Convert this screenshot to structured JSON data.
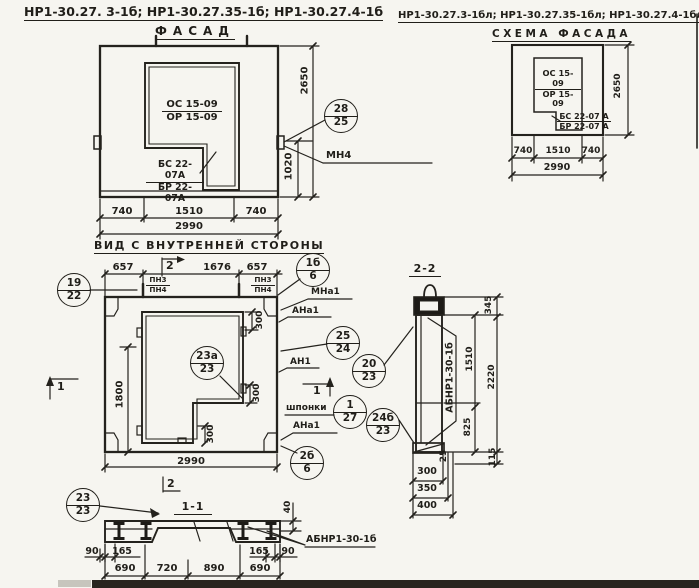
{
  "titles": {
    "left": "НР1-30.27. 3-1б;  НР1-30.27.35-1б;  НР1-30.27.4-1б",
    "right": "НР1-30.27.3-1бл; НР1-30.27.35-1бл; НР1-30.27.4-1бл",
    "facade": "ФАСАД",
    "schema": "СХЕМА ФАСАДА",
    "inner": "ВИД С ВНУТРЕННЕЙ СТОРОНЫ",
    "section_2_2": "2-2",
    "section_1_1": "1-1"
  },
  "facade": {
    "opening_series_top": "ОС 15-09",
    "opening_series_bottom": "ОР 15-09",
    "sill_series_top": "БС 22-07А",
    "sill_series_bottom": "БР 22-07А",
    "dim_740_left": "740",
    "dim_1510": "1510",
    "dim_740_right": "740",
    "dim_total": "2990",
    "dim_height": "2650",
    "dim_1020": "1020",
    "callout": {
      "t": "28",
      "b": "25"
    },
    "label_mn4": "МН4"
  },
  "schema": {
    "opening_series_top": "ОС 15-09",
    "opening_series_bottom": "ОР 15-09",
    "sill_series_top": "БС 22-07 А",
    "sill_series_bottom": "БР 22-07 А",
    "dim_740_left": "740",
    "dim_1510": "1510",
    "dim_740_right": "740",
    "dim_total": "2990",
    "dim_height": "2650"
  },
  "inner": {
    "dim_657_left": "657",
    "dim_1676": "1676",
    "dim_657_right": "657",
    "pn_top": "ПН3",
    "pn_bottom": "ПН4",
    "dim_1800": "1800",
    "dim_300_a": "300",
    "dim_300_b": "300",
    "dim_300_c": "300",
    "dim_total": "2990",
    "marker_1": "1",
    "marker_2": "2",
    "label_mna1": "МНа1",
    "label_ana1_top": "АНа1",
    "label_an1": "АН1",
    "label_shponki": "шпонки",
    "label_ana1_bottom": "АНа1",
    "callouts": {
      "c19": {
        "t": "19",
        "b": "22"
      },
      "c1b": {
        "t": "1б",
        "b": "6"
      },
      "c25": {
        "t": "25",
        "b": "24"
      },
      "c20": {
        "t": "20",
        "b": "23"
      },
      "c23a": {
        "t": "23а",
        "b": "23"
      },
      "c127": {
        "t": "1",
        "b": "27"
      },
      "c24b": {
        "t": "24б",
        "b": "23"
      },
      "c2b": {
        "t": "2б",
        "b": "6"
      }
    }
  },
  "sec22": {
    "label_panel": "АБНР1-30-1б",
    "dim_345": "345",
    "dim_1510": "1510",
    "dim_2220": "2220",
    "dim_825": "825",
    "dim_115": "115",
    "dim_25": "25",
    "dim_300": "300",
    "dim_350": "350",
    "dim_400": "400"
  },
  "sec11": {
    "label_panel": "АБНР1-30-1б",
    "callout": {
      "t": "23",
      "b": "23"
    },
    "dim_40": "40",
    "dim_90_left": "90",
    "dim_165_left": "165",
    "dim_165_right": "165",
    "dim_90_right": "90",
    "dim_690_a": "690",
    "dim_720": "720",
    "dim_890": "890",
    "dim_690_b": "690"
  }
}
